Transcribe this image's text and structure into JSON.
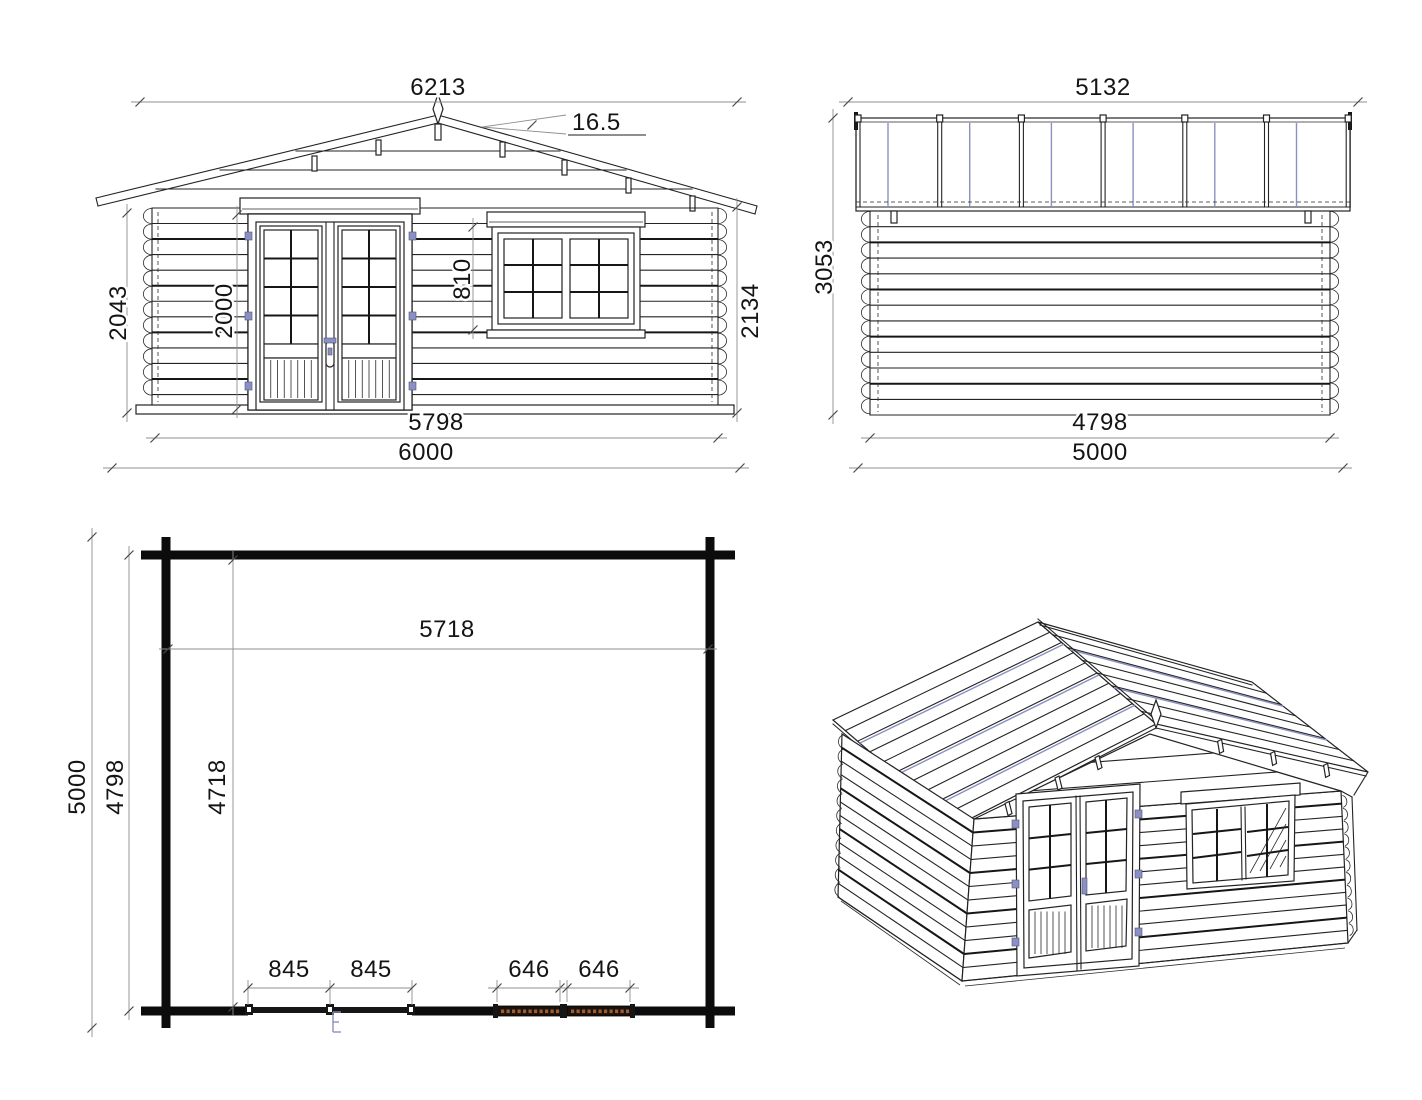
{
  "sheet": {
    "description": "Log cabin technical drawing, four views",
    "background": "#ffffff"
  },
  "colors": {
    "line": "#232323",
    "dimension_line": "#8f8f8f",
    "dimension_text": "#141414",
    "accent_hardware": "#8b90c2",
    "window_plan_hatch": "#a15c2e",
    "plan_wall": "#0c0c0c"
  },
  "views": {
    "front_elevation": {
      "name": "front elevation",
      "dimensions": {
        "roof_width": "6213",
        "roof_pitch": "16.5",
        "eave_wall_height": "2043",
        "door_height": "2000",
        "window_height": "810",
        "overall_height": "2134",
        "wall_width": "5798",
        "overall_width": "6000"
      }
    },
    "side_elevation": {
      "name": "side elevation",
      "dimensions": {
        "roof_depth": "5132",
        "overall_height": "3053",
        "wall_depth": "4798",
        "overall_depth": "5000"
      }
    },
    "floor_plan": {
      "name": "floor plan",
      "dimensions": {
        "interior_width": "5718",
        "overall_depth": "5000",
        "wall_outer_depth": "4798",
        "interior_depth": "4718",
        "door_leaf_left": "845",
        "door_leaf_right": "845",
        "window_left": "646",
        "window_right": "646"
      }
    },
    "perspective": {
      "name": "3d view"
    }
  }
}
